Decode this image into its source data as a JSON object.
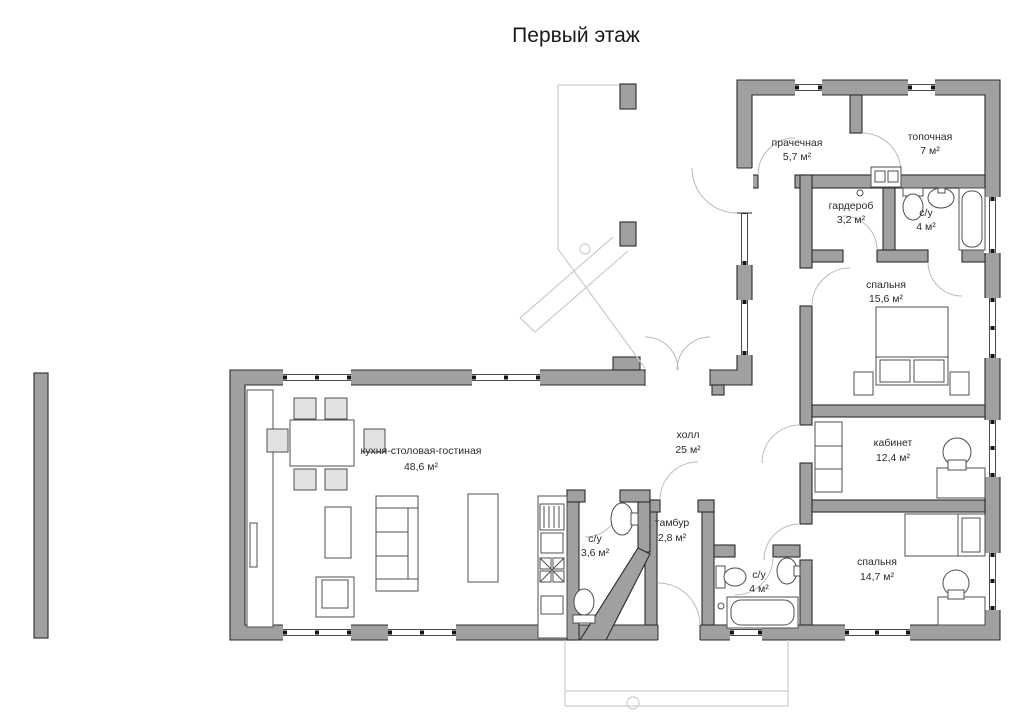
{
  "title": "Первый этаж",
  "floor_plan": {
    "rooms": [
      {
        "id": "laundry",
        "name": "прачечная",
        "area": "5,7 м²"
      },
      {
        "id": "boiler-room",
        "name": "топочная",
        "area": "7 м²"
      },
      {
        "id": "wardrobe",
        "name": "гардероб",
        "area": "3,2 м²"
      },
      {
        "id": "bathroom-top",
        "name": "с/у",
        "area": "4 м²"
      },
      {
        "id": "bedroom-1",
        "name": "спальня",
        "area": "15,6 м²"
      },
      {
        "id": "hall",
        "name": "холл",
        "area": "25 м²"
      },
      {
        "id": "office",
        "name": "кабинет",
        "area": "12,4 м²"
      },
      {
        "id": "kitchen-living",
        "name": "кухня-столовая-гостиная",
        "area": "48,6 м²"
      },
      {
        "id": "bathroom-small",
        "name": "с/у",
        "area": "3,6 м²"
      },
      {
        "id": "vestibule",
        "name": "тамбур",
        "area": "2,8 м²"
      },
      {
        "id": "bathroom-bottom",
        "name": "с/у",
        "area": "4 м²"
      },
      {
        "id": "bedroom-2",
        "name": "спальня",
        "area": "14,7 м²"
      }
    ],
    "colors": {
      "wall_fill": "#a0a0a0",
      "wall_outline": "#2b2b2b",
      "furniture_line": "#4f4f4f",
      "porch_line": "#cccccc"
    }
  }
}
